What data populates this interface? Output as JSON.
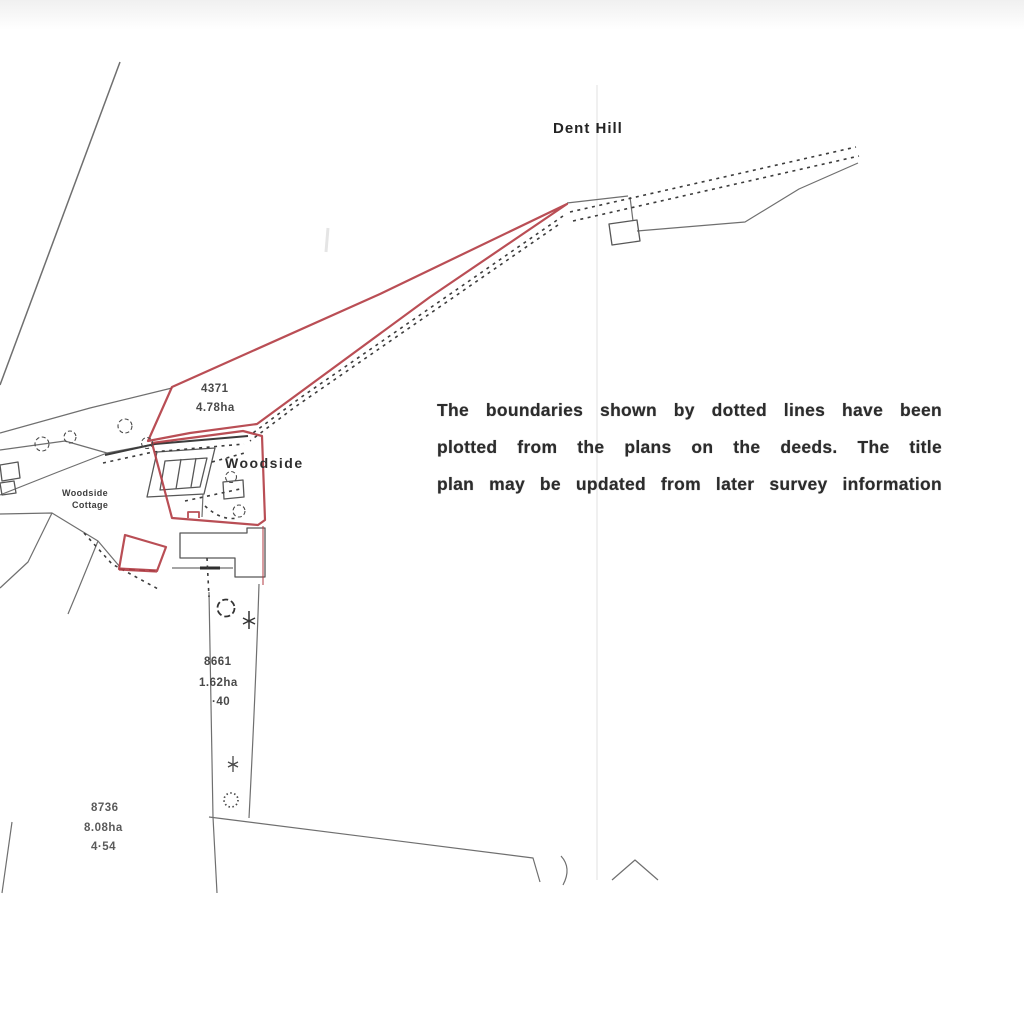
{
  "labels": {
    "dent_hill": "Dent Hill",
    "woodside": "Woodside",
    "cottage_line1": "Woodside",
    "cottage_line2": "Cottage"
  },
  "parcels": [
    {
      "number": "4371",
      "hectares": "4.78ha"
    },
    {
      "number": "8661",
      "hectares": "1.62ha",
      "acres": "·40"
    },
    {
      "number": "8736",
      "hectares": "8.08ha",
      "acres": "4·54"
    }
  ],
  "note": {
    "lines": [
      "The boundaries shown by dotted lines have been",
      "plotted from the plans on the deeds.  The title",
      "plan may be updated from later survey information"
    ]
  },
  "colors": {
    "boundary_red": "#b23b43",
    "linework_grey": "#6f6f6f",
    "track_dark": "#3c3c3c",
    "note_text": "#2c2c2c"
  }
}
